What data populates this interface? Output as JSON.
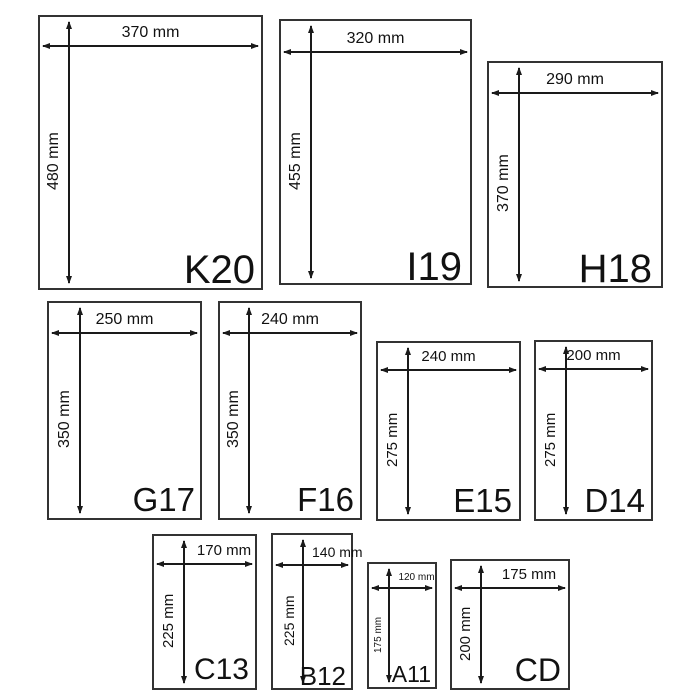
{
  "colors": {
    "background": "#ffffff",
    "box_border": "#333333",
    "ink": "#1a1a1a"
  },
  "unit": "mm",
  "envelopes": [
    {
      "code": "K20",
      "width_label": "370 mm",
      "height_label": "480 mm",
      "width_mm": 370,
      "height_mm": 480
    },
    {
      "code": "I19",
      "width_label": "320 mm",
      "height_label": "455 mm",
      "width_mm": 320,
      "height_mm": 455
    },
    {
      "code": "H18",
      "width_label": "290 mm",
      "height_label": "370 mm",
      "width_mm": 290,
      "height_mm": 370
    },
    {
      "code": "G17",
      "width_label": "250 mm",
      "height_label": "350 mm",
      "width_mm": 250,
      "height_mm": 350
    },
    {
      "code": "F16",
      "width_label": "240 mm",
      "height_label": "350 mm",
      "width_mm": 240,
      "height_mm": 350
    },
    {
      "code": "E15",
      "width_label": "240 mm",
      "height_label": "275 mm",
      "width_mm": 240,
      "height_mm": 275
    },
    {
      "code": "D14",
      "width_label": "200 mm",
      "height_label": "275 mm",
      "width_mm": 200,
      "height_mm": 275
    },
    {
      "code": "C13",
      "width_label": "170 mm",
      "height_label": "225 mm",
      "width_mm": 170,
      "height_mm": 225
    },
    {
      "code": "B12",
      "width_label": "140 mm",
      "height_label": "225 mm",
      "width_mm": 140,
      "height_mm": 225
    },
    {
      "code": "A11",
      "width_label": "120 mm",
      "height_label": "175 mm",
      "width_mm": 120,
      "height_mm": 175
    },
    {
      "code": "CD",
      "width_label": "175 mm",
      "height_label": "200 mm",
      "width_mm": 175,
      "height_mm": 200
    }
  ]
}
